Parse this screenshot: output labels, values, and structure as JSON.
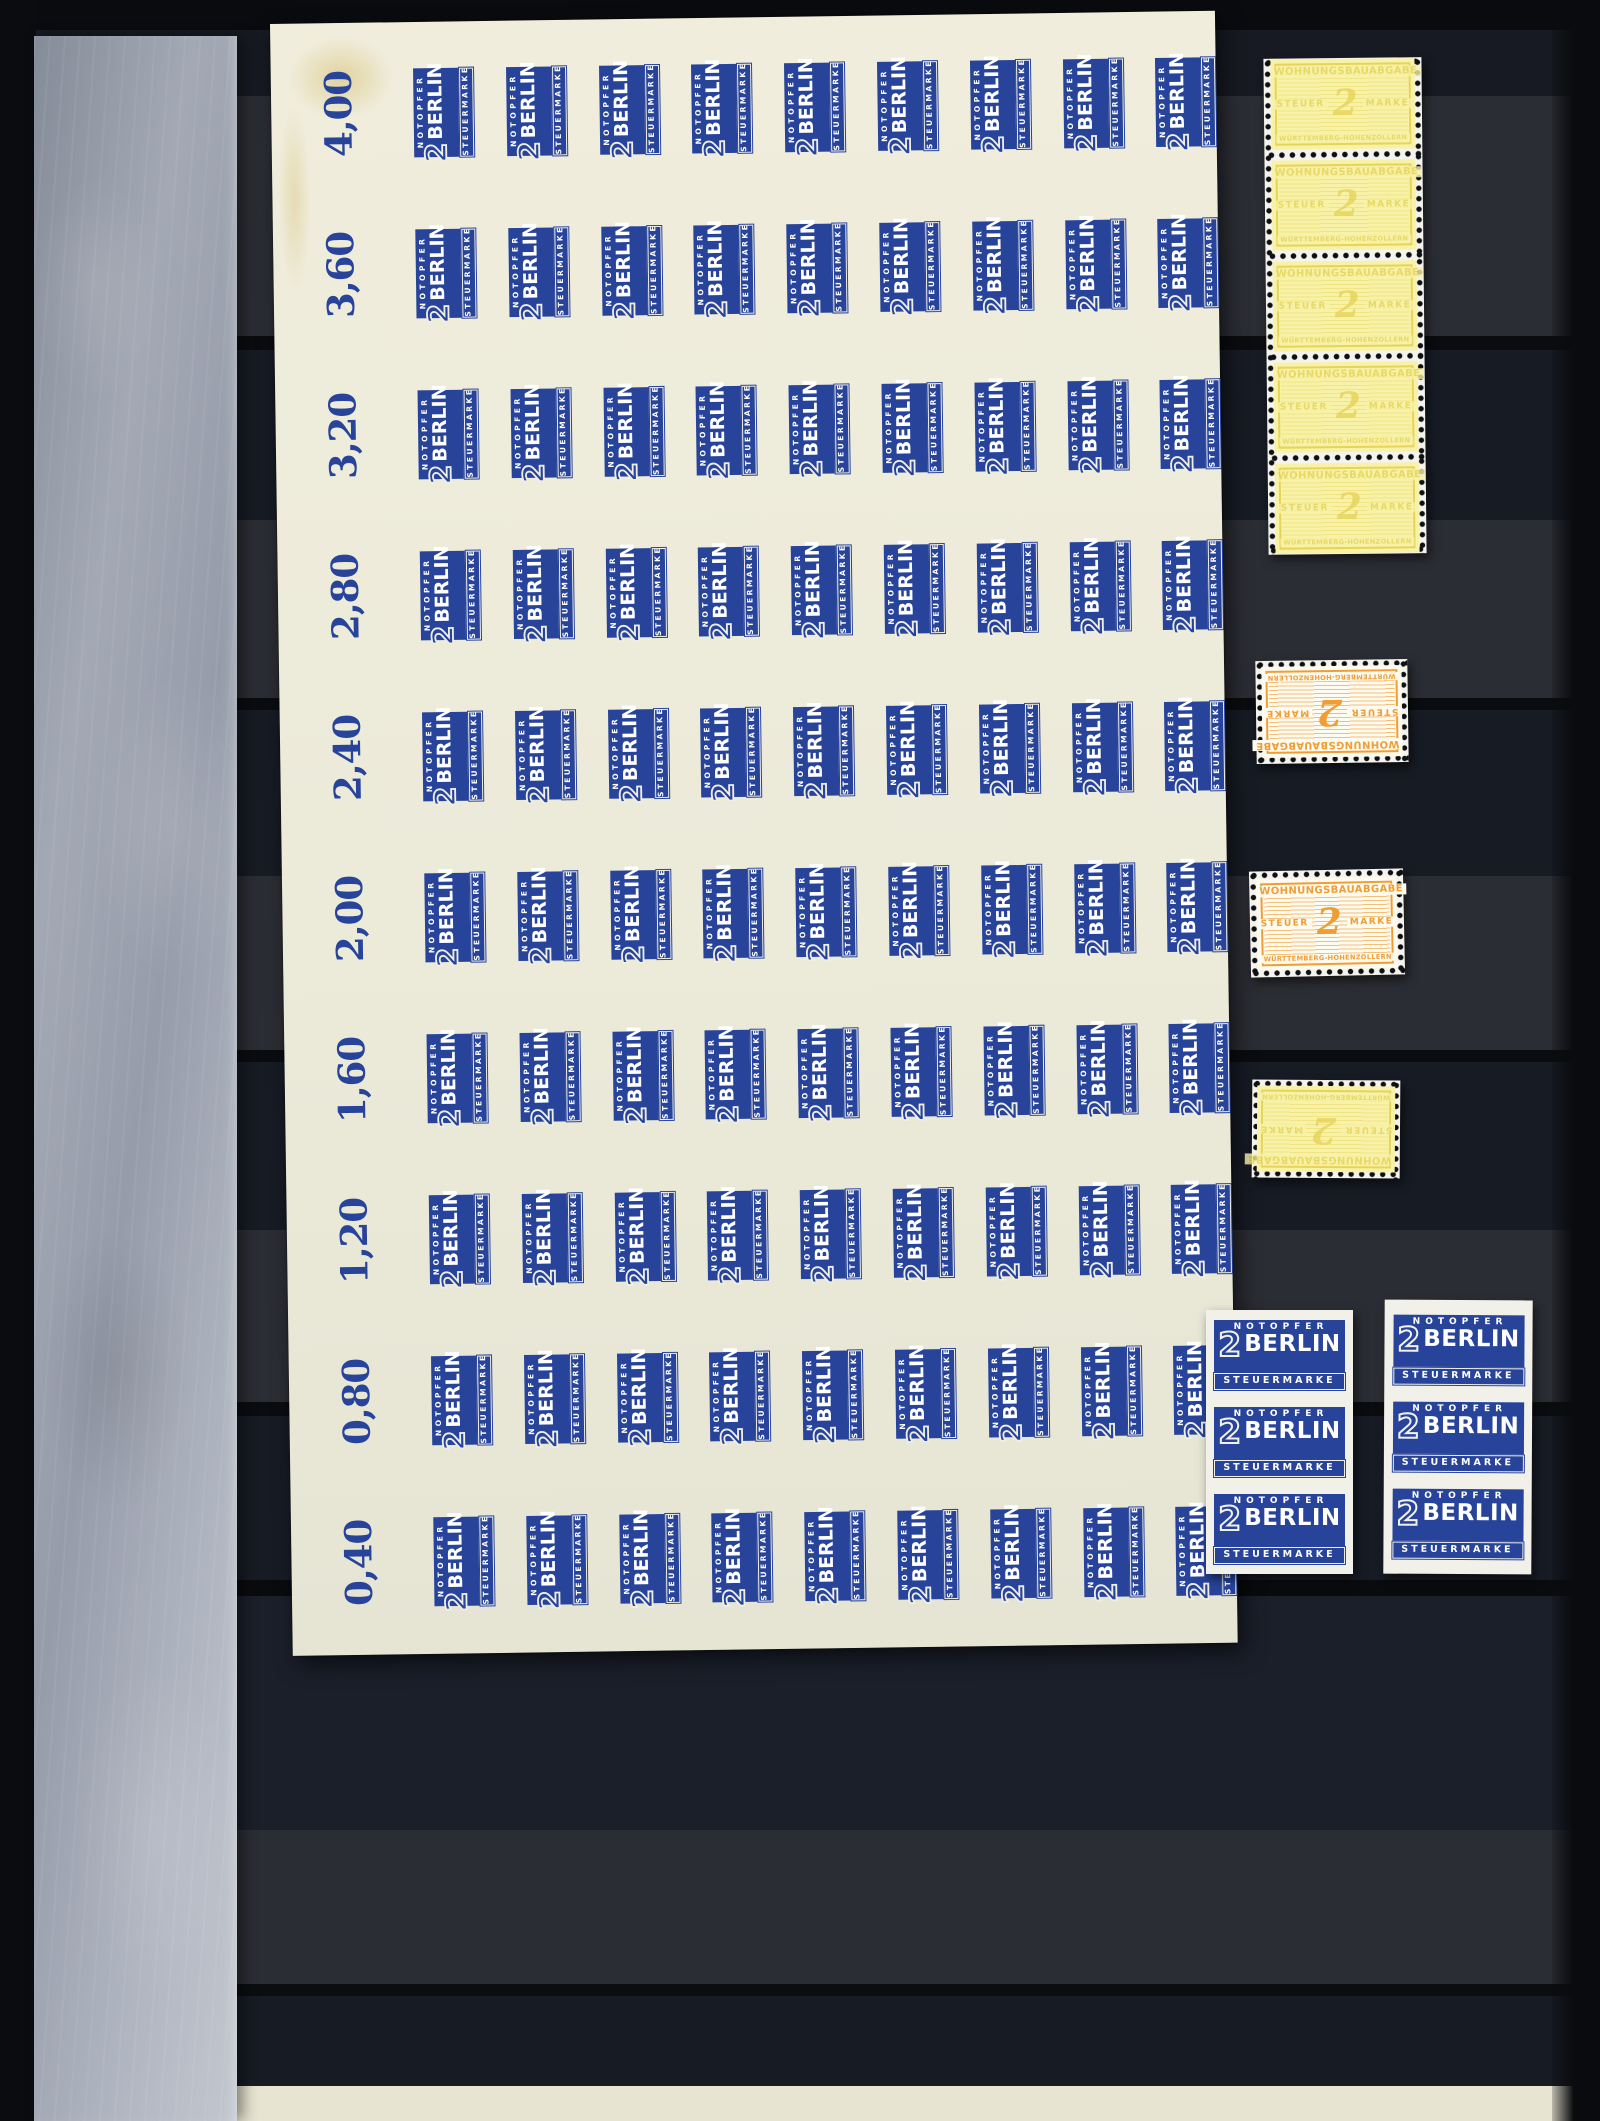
{
  "designs": {
    "notopfer": {
      "header": "NOTOPFER",
      "numeral": "2",
      "name": "BERLIN",
      "footer": "STEUERMARKE"
    },
    "wohnungsbau": {
      "header": "WOHNUNGSBAUABGABE",
      "left": "STEUER",
      "numeral": "2",
      "right": "MARKE",
      "footer": "WÜRTTEMBERG-HOHENZOLLERN"
    }
  },
  "sheet": {
    "margin_labels": [
      "4,00",
      "3,60",
      "3,20",
      "2,80",
      "2,40",
      "2,00",
      "1,60",
      "1,20",
      "0,80",
      "0,40"
    ],
    "rows": 10,
    "stamps_per_row": 9,
    "orientation": "rotated-90"
  },
  "loose_items": {
    "yellow_strip": {
      "design": "wohnungsbau",
      "count": 5,
      "perforated": true,
      "inverted": false
    },
    "orange_stamp_top": {
      "design": "wohnungsbau",
      "count": 1,
      "perforated": true,
      "inverted": true
    },
    "orange_stamp_bottom": {
      "design": "wohnungsbau",
      "count": 1,
      "perforated": true,
      "inverted": false
    },
    "yellow_stamp_single": {
      "design": "wohnungsbau",
      "count": 1,
      "perforated": true,
      "inverted": true
    },
    "blue_strip_left": {
      "design": "notopfer",
      "count": 3,
      "perforated": false
    },
    "blue_strip_right": {
      "design": "notopfer",
      "count": 3,
      "perforated": false
    }
  },
  "colors": {
    "notopfer_ink": "#27439a",
    "wohnungsbau_orange": "#f09d35",
    "wohnungsbau_yellow": "#e6d35a",
    "sheet_paper": "#ecead9",
    "strip_paper": "#f2f1e9",
    "album_dark": "#171b24",
    "album_light_band": "#2b2d34",
    "glassine_gray": "#a6acb8",
    "page_edge_cream": "#e8e4d2"
  }
}
